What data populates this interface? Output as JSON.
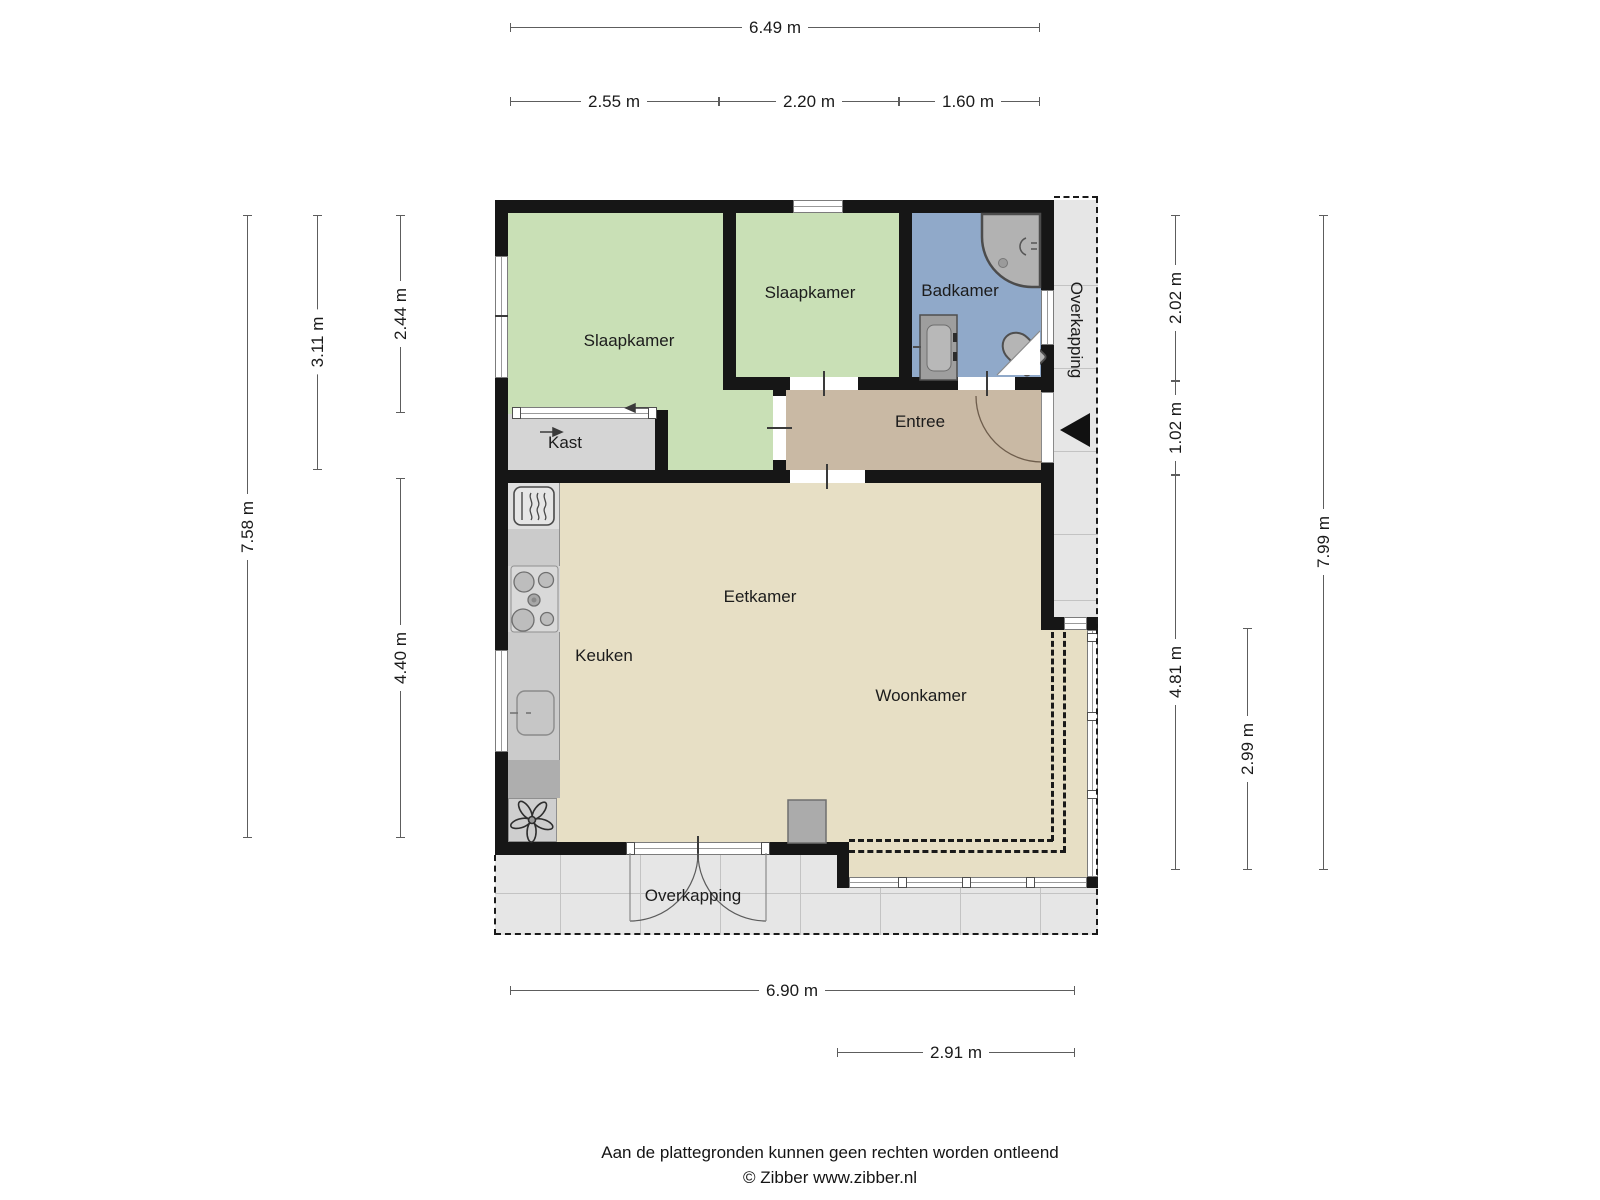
{
  "floorplan": {
    "rooms": {
      "bedroom_left": "Slaapkamer",
      "bedroom_middle": "Slaapkamer",
      "bathroom": "Badkamer",
      "closet": "Kast",
      "entry": "Entree",
      "dining_room": "Eetkamer",
      "kitchen": "Keuken",
      "living_room": "Woonkamer",
      "canopy_right": "Overkapping",
      "canopy_bottom": "Overkapping"
    },
    "dimensions": {
      "top_total": "6.49 m",
      "top_seg1": "2.55 m",
      "top_seg2": "2.20 m",
      "top_seg3": "1.60 m",
      "left_total": "7.58 m",
      "left_seg1": "3.11 m",
      "left_seg2": "2.44 m",
      "left_seg3": "4.40 m",
      "right_seg1": "2.02 m",
      "right_seg2": "1.02 m",
      "right_seg3": "4.81 m",
      "right_seg4": "2.99 m",
      "right_total": "7.99 m",
      "bottom_total": "6.90 m",
      "bottom_seg1": "2.91 m"
    },
    "colors": {
      "wall": "#161616",
      "bedroom_green": "#c9e0b6",
      "bathroom_blue": "#90a9c9",
      "entry_tan": "#c9b9a4",
      "living_tan": "#e7dfc5",
      "closet_gray": "#d5d5d5",
      "canopy_gray": "#e6e6e6"
    },
    "icons": [
      "oven-icon",
      "stove-icon",
      "kitchen-sink-icon",
      "fan-icon",
      "shower-icon",
      "shower-head-icon",
      "washbasin-icon",
      "toilet-icon",
      "fireplace-icon",
      "entrance-arrow-icon",
      "sliding-door-arrow-icon"
    ],
    "footer": {
      "disclaimer": "Aan de plattegronden kunnen geen rechten worden ontleend",
      "credit": "© Zibber www.zibber.nl"
    }
  }
}
